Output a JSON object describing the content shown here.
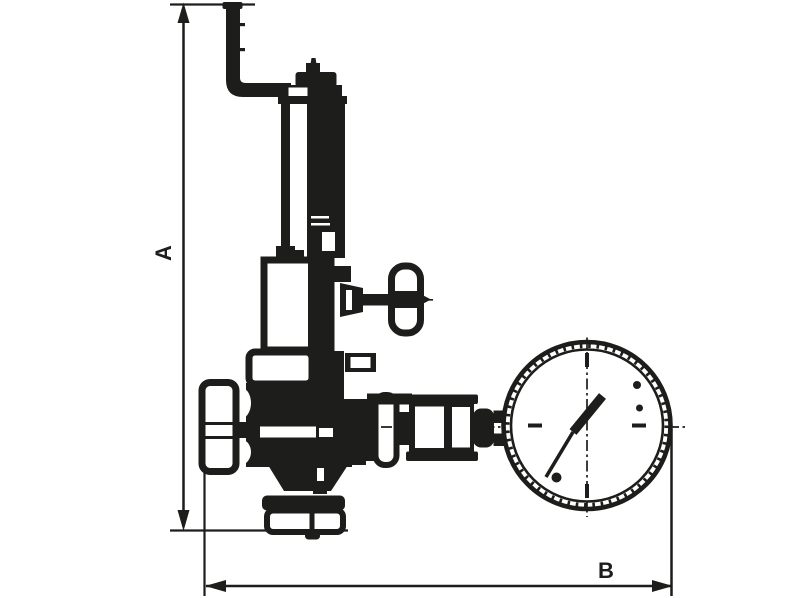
{
  "canvas": {
    "width": 800,
    "height": 598,
    "background": "#ffffff",
    "ink": "#1d1d1b"
  },
  "dimensions": {
    "a": {
      "label": "A",
      "orientation": "vertical"
    },
    "b": {
      "label": "B",
      "orientation": "horizontal"
    }
  },
  "parts": {
    "exhaust_pipe": "exhaust-elbow-pipe",
    "bonnet": "spring-housing-column",
    "adjuster": "adjusting-spike-cap",
    "side_tap": "side-tap-with-oval-handle",
    "body": "valve-body",
    "inlet_cap": "inlet-cap-nut",
    "bottom_outlet": "bottom-outlet-connection",
    "gauge_union": "gauge-union-nut",
    "gauge": "pressure-gauge-dial",
    "needle": "gauge-needle"
  }
}
